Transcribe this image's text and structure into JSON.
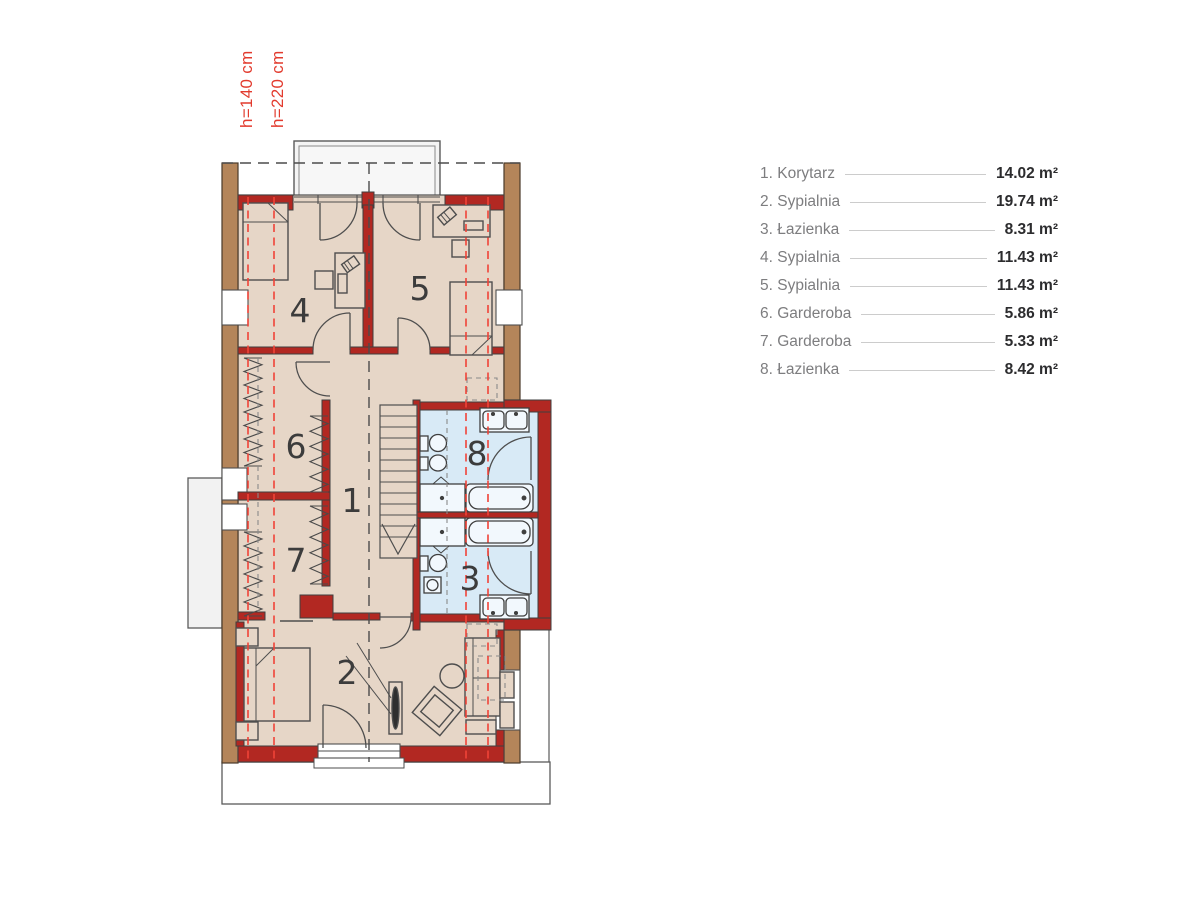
{
  "annotations": {
    "height_label_1": "h=140 cm",
    "height_label_2": "h=220 cm"
  },
  "legend": {
    "rooms": [
      {
        "label": "1. Korytarz",
        "area": "14.02 m²"
      },
      {
        "label": "2. Sypialnia",
        "area": "19.74 m²"
      },
      {
        "label": "3. Łazienka",
        "area": "8.31 m²"
      },
      {
        "label": "4. Sypialnia",
        "area": "11.43 m²"
      },
      {
        "label": "5. Sypialnia",
        "area": "11.43 m²"
      },
      {
        "label": "6. Garderoba",
        "area": "5.86 m²"
      },
      {
        "label": "7. Garderoba",
        "area": "5.33 m²"
      },
      {
        "label": "8. Łazienka",
        "area": "8.42 m²"
      }
    ]
  },
  "plan": {
    "room_numbers": {
      "r1": "1",
      "r2": "2",
      "r3": "3",
      "r4": "4",
      "r5": "5",
      "r6": "6",
      "r7": "7",
      "r8": "8"
    }
  },
  "colors": {
    "wall_red": "#b22822",
    "wood_brown": "#b4855a",
    "floor_beige": "#e6d6c7",
    "bath_blue": "#d8eaf6",
    "outline_dark": "#4e4e4e",
    "dash_red": "#f04338",
    "annotation_red": "#e23b2e",
    "legend_label_gray": "#7d7d7f",
    "legend_value_dark": "#2c2c2e"
  }
}
